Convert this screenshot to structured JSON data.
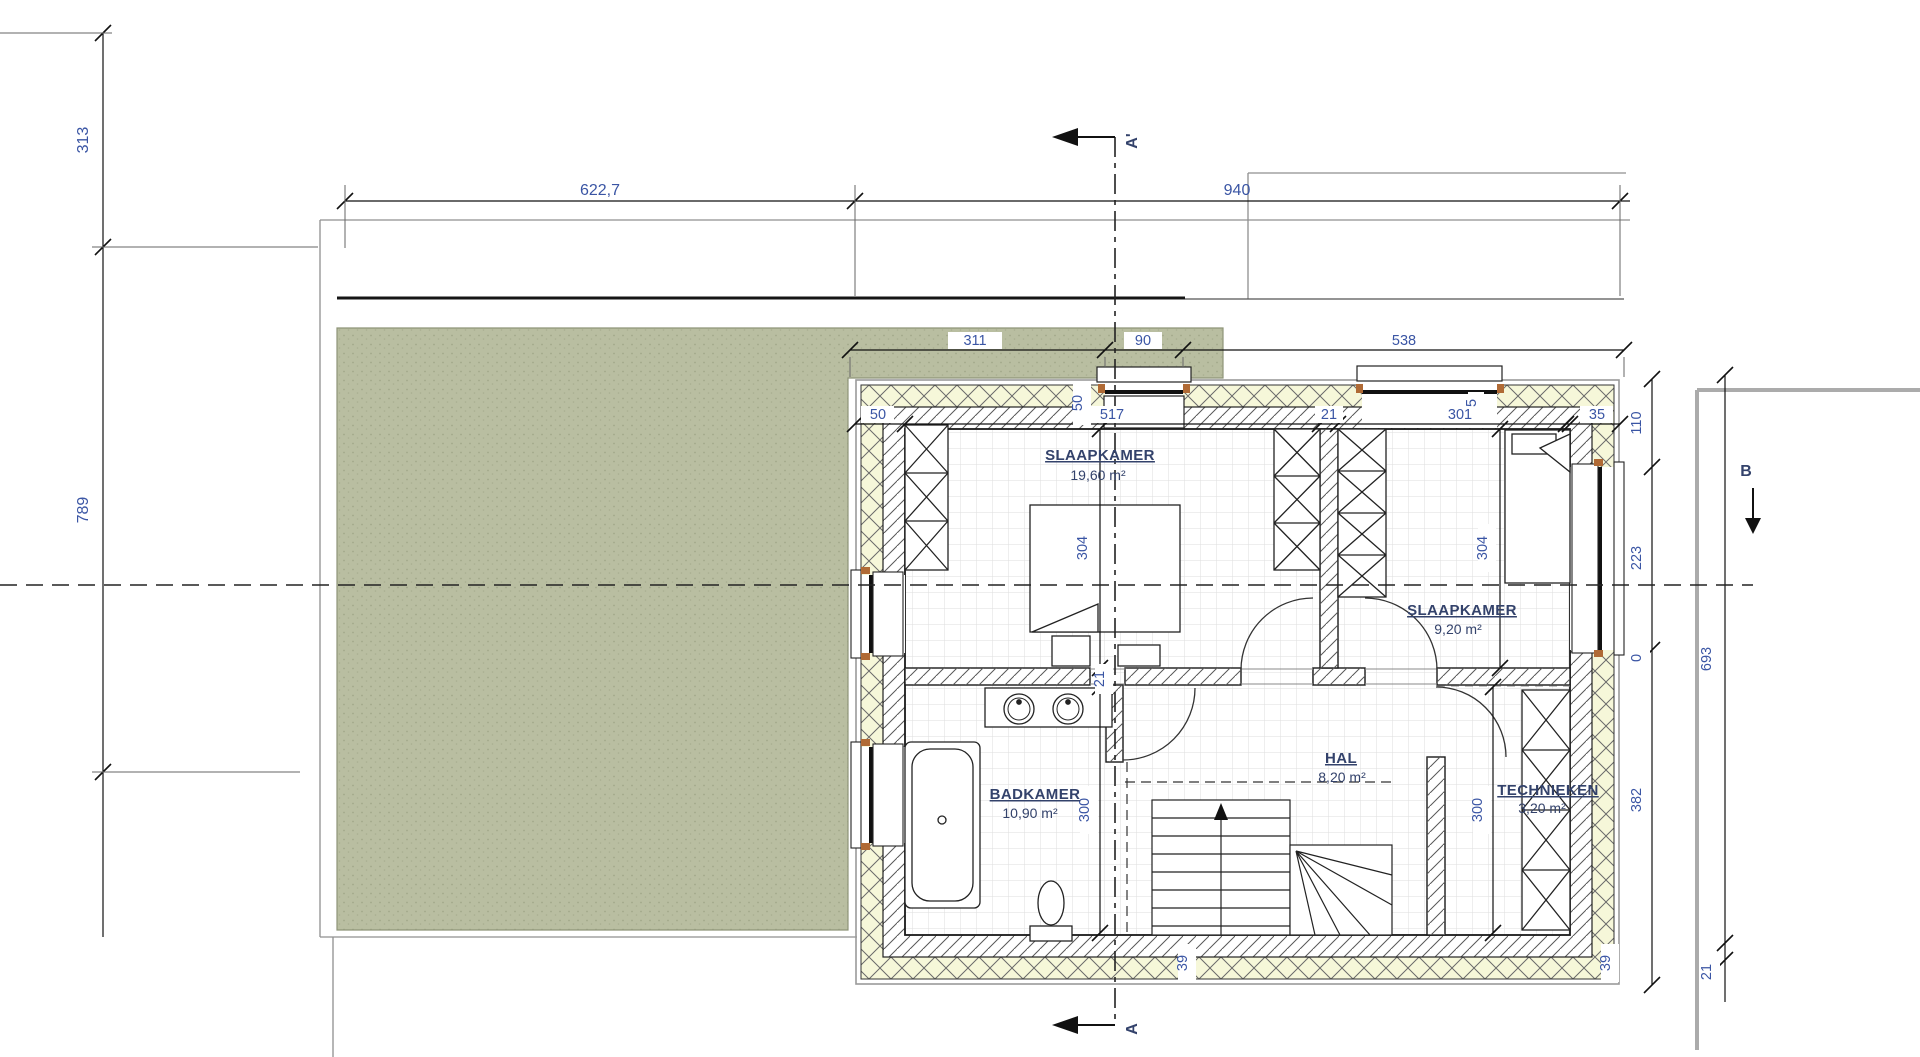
{
  "rooms": [
    {
      "name": "SLAAPKAMER",
      "area": "19,60 m²"
    },
    {
      "name": "SLAAPKAMER",
      "area": "9,20 m²"
    },
    {
      "name": "BADKAMER",
      "area": "10,90 m²"
    },
    {
      "name": "HAL",
      "area": "8,20 m²"
    },
    {
      "name": "TECHNIEKEN",
      "area": "3,20 m²"
    }
  ],
  "dims": {
    "left_outer": [
      "313",
      "789"
    ],
    "top_outer": [
      "622,7",
      "940"
    ],
    "roof": [
      "311",
      "90",
      "538"
    ],
    "top_chain": [
      "50",
      "50",
      "517",
      "21",
      "301",
      "5",
      "35"
    ],
    "right_inner": [
      "110",
      "223",
      "0",
      "382"
    ],
    "right_outer": [
      "693",
      "21"
    ],
    "bedroom_depth": [
      "304",
      "304"
    ],
    "room_depth": [
      "300",
      "300"
    ],
    "bottom_wall": [
      "39",
      "39"
    ],
    "wall_opening": "21"
  },
  "sections": {
    "a_prime": "A'",
    "a": "A",
    "b": "B"
  },
  "colors": {
    "roof_green": "#b9bea1",
    "insulation_yellow": "#f6f7d9",
    "dimension_text": "#3a55a4",
    "room_text": "#33426b"
  }
}
